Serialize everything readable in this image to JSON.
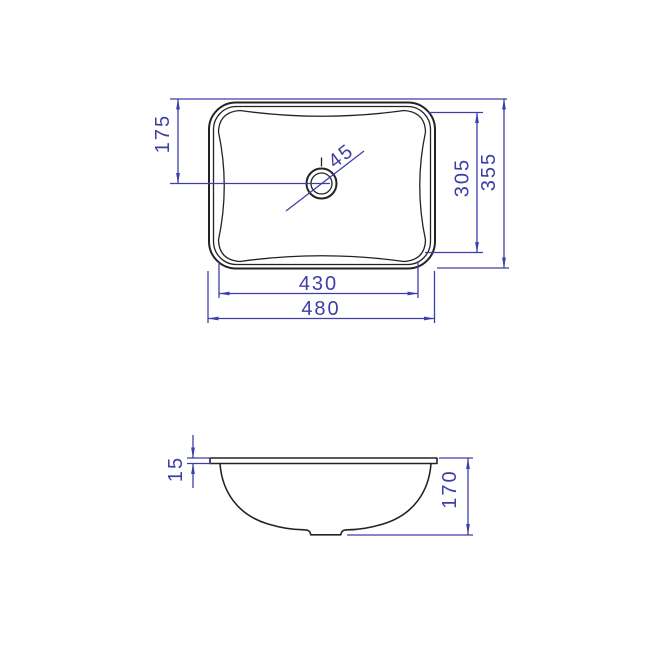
{
  "meta": {
    "title": "Basin technical drawing — plan and section views"
  },
  "colors": {
    "dimension_blue": "#3e3ea8",
    "outline_black": "#232323",
    "background": "#ffffff"
  },
  "top_view": {
    "name": "Plan view of rectangular basin",
    "dims": {
      "drain_offset_from_top": "175",
      "drain_diameter": "45",
      "bowl_inner_depth": "305",
      "overall_depth": "355",
      "bowl_inner_width": "430",
      "overall_width": "480"
    }
  },
  "side_view": {
    "name": "Section view of basin",
    "dims": {
      "rim_thickness": "15",
      "bowl_height": "170"
    }
  }
}
